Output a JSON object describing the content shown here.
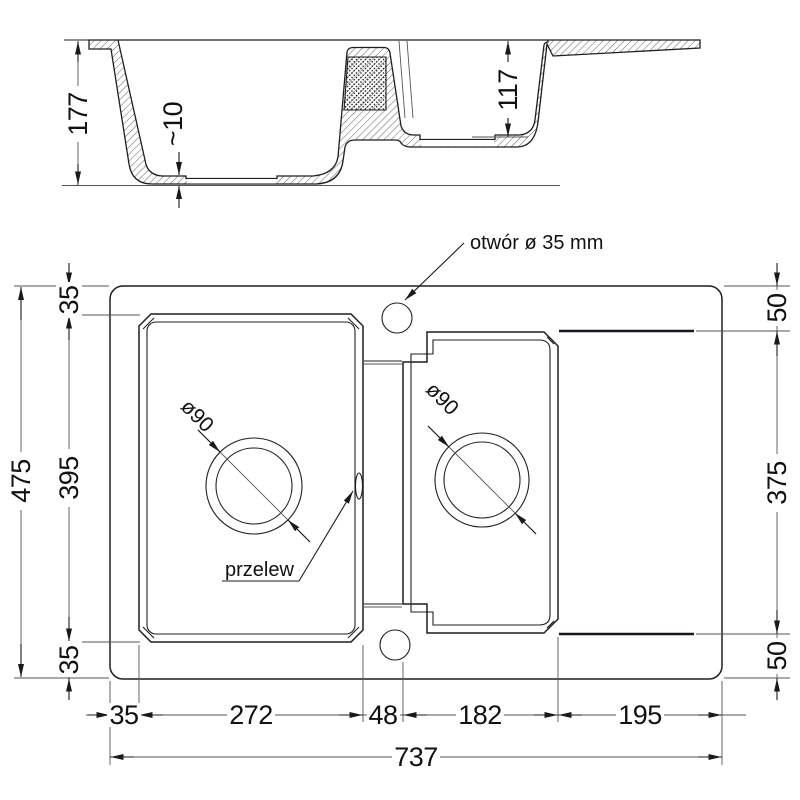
{
  "section": {
    "dims": {
      "depth_main": "177",
      "bottom_thickness": "~10",
      "depth_small": "117"
    }
  },
  "plan": {
    "annotations": {
      "tap_hole": "otwór ø 35 mm",
      "overflow": "przelew",
      "drain_main": "ø90",
      "drain_small": "ø90"
    },
    "left": {
      "total": "475",
      "margin_top": "35",
      "bowl_height": "395",
      "margin_bottom": "35"
    },
    "right": {
      "margin_top": "50",
      "drainer_height": "375",
      "margin_bottom": "50"
    },
    "bottom": {
      "total": "737",
      "margin_left": "35",
      "bowl_main_width": "272",
      "divider": "48",
      "bowl_small_width": "182",
      "drainer_width": "195"
    }
  },
  "colors": {
    "line": "#1f1f1f",
    "edge_accent": "#141824",
    "background": "#ffffff"
  }
}
